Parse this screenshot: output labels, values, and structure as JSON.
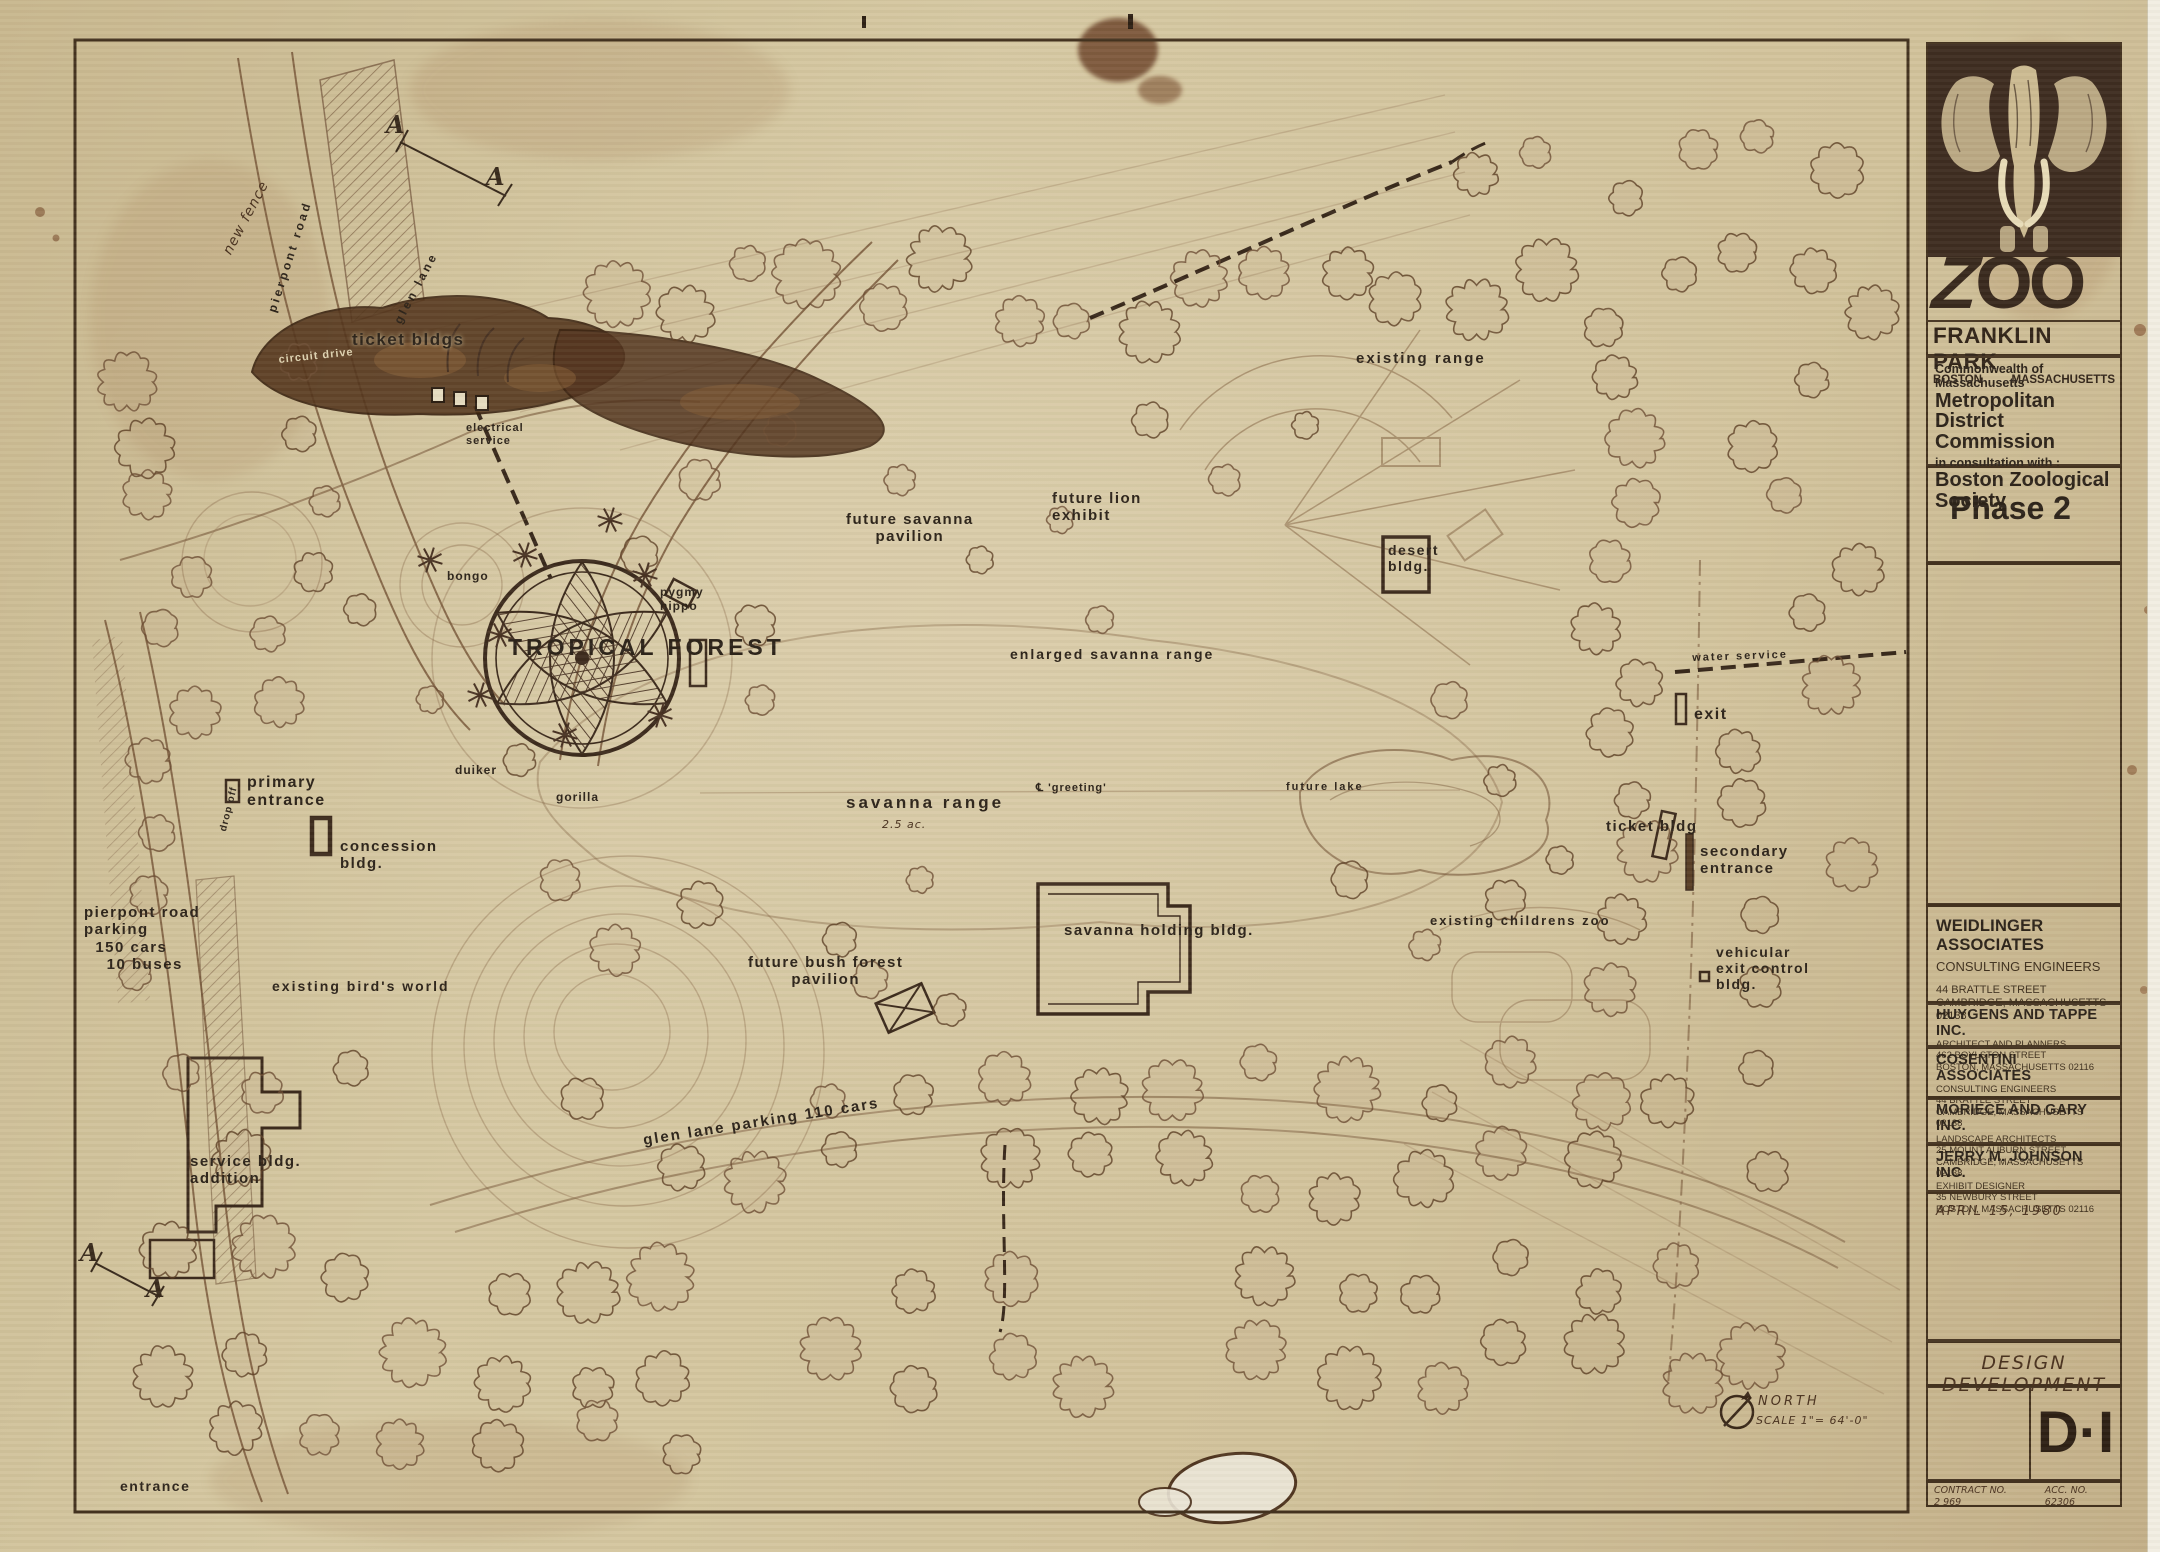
{
  "document": {
    "type_note": "scanned zoo master-plan drawing",
    "stage_stamp": "DESIGN DEVELOPMENT",
    "sheet_number": "D·I",
    "date_note": "APRIL 15, 1980",
    "contract": {
      "label": "CONTRACT NO.\n2 969",
      "acc_label": "ACC. NO.\n62306"
    }
  },
  "title_block": {
    "logo": {
      "zoo": "ZOO",
      "park": "FRANKLIN PARK",
      "city": "BOSTON",
      "state": "MASSACHUSETTS"
    },
    "commission": {
      "line1": "Commonwealth of Massachusetts",
      "line2": "Metropolitan District Commission",
      "line3": "in consultation with :",
      "line4": "Boston Zoological Society"
    },
    "phase": "Phase 2",
    "consultants": [
      {
        "name": "WEIDLINGER ASSOCIATES",
        "role": "CONSULTING ENGINEERS",
        "address1": "44 BRATTLE STREET",
        "address2": "CAMBRIDGE, MASSACHUSETTS 02138"
      },
      {
        "name": "HUYGENS AND TAPPE INC.",
        "role": "ARCHITECT AND PLANNERS",
        "address1": "462 BOYLSTON STREET",
        "address2": "BOSTON, MASSACHUSETTS 02116"
      },
      {
        "name": "COSENTINI ASSOCIATES",
        "role": "CONSULTING ENGINEERS",
        "address1": "44 BRATTLE STREET",
        "address2": "CAMBRIDGE, MASSACHUSETTS 02138"
      },
      {
        "name": "MORIECE AND GARY INC.",
        "role": "LANDSCAPE ARCHITECTS",
        "address1": "25 MOUNT AUBURN STREET",
        "address2": "CAMBRIDGE, MASSACHUSETTS 02138"
      },
      {
        "name": "JERRY M. JOHNSON INC.",
        "role": "EXHIBIT DESIGNER",
        "address1": "35 NEWBURY STREET",
        "address2": "BOSTON, MASSACHUSETTS 02116"
      }
    ]
  },
  "plan": {
    "labels": {
      "section_a": "A",
      "new_fence": "new fence",
      "pierpont_road": "pierpont  road",
      "glen_lane": "glen  lane",
      "ticket_bldgs": "ticket bldgs",
      "circuit_drive": "circuit   drive",
      "electrical_service": "electrical\nservice",
      "bongo": "bongo",
      "pygmy_hippo": "pygmy\nhippo",
      "tropical_forest": "TROPICAL  FOREST",
      "duiker": "duiker",
      "gorilla": "gorilla",
      "drop_off": "drop  off",
      "primary_entrance": "primary\nentrance",
      "concession_bldg": "concession\nbldg.",
      "pierpont_parking": "pierpont  road\nparking\n  150 cars\n    10 buses",
      "existing_birds_world": "existing  bird's  world",
      "service_bldg_addition": "service  bldg.\naddition",
      "entrance": "entrance",
      "glen_lane_parking": "glen   lane   parking   110  cars",
      "future_bush_forest": "future  bush  forest\npavilion",
      "savanna_holding": "savanna  holding  bldg.",
      "savanna_range": "savanna   range",
      "savanna_acreage_note": "2.5 ac.",
      "greeting": "℄  'greeting'",
      "future_lake": "future   lake",
      "future_savanna_pavilion": "future  savanna\npavilion",
      "future_lion_exhibit": "future  lion\nexhibit",
      "existing_range": "existing  range",
      "desert_bldg": "desert\nbldg.",
      "enlarged_savanna_range": "enlarged  savanna  range",
      "water_service": "water    service",
      "exit": "exit",
      "ticket_bldg": "ticket  bldg",
      "secondary_entrance": "secondary\nentrance",
      "existing_childrens_zoo": "existing  childrens  zoo",
      "vehicular_exit_control": "vehicular\nexit control\nbldg.",
      "north": "NORTH",
      "scale": "SCALE   1\"= 64'-0\""
    }
  },
  "colors": {
    "paper": "#d3c49e",
    "ink_brown": "#6b4c33",
    "ink_dark": "#3c2c1f",
    "logo_panel": "#3f2d21",
    "logo_cream": "#cdbb92"
  }
}
